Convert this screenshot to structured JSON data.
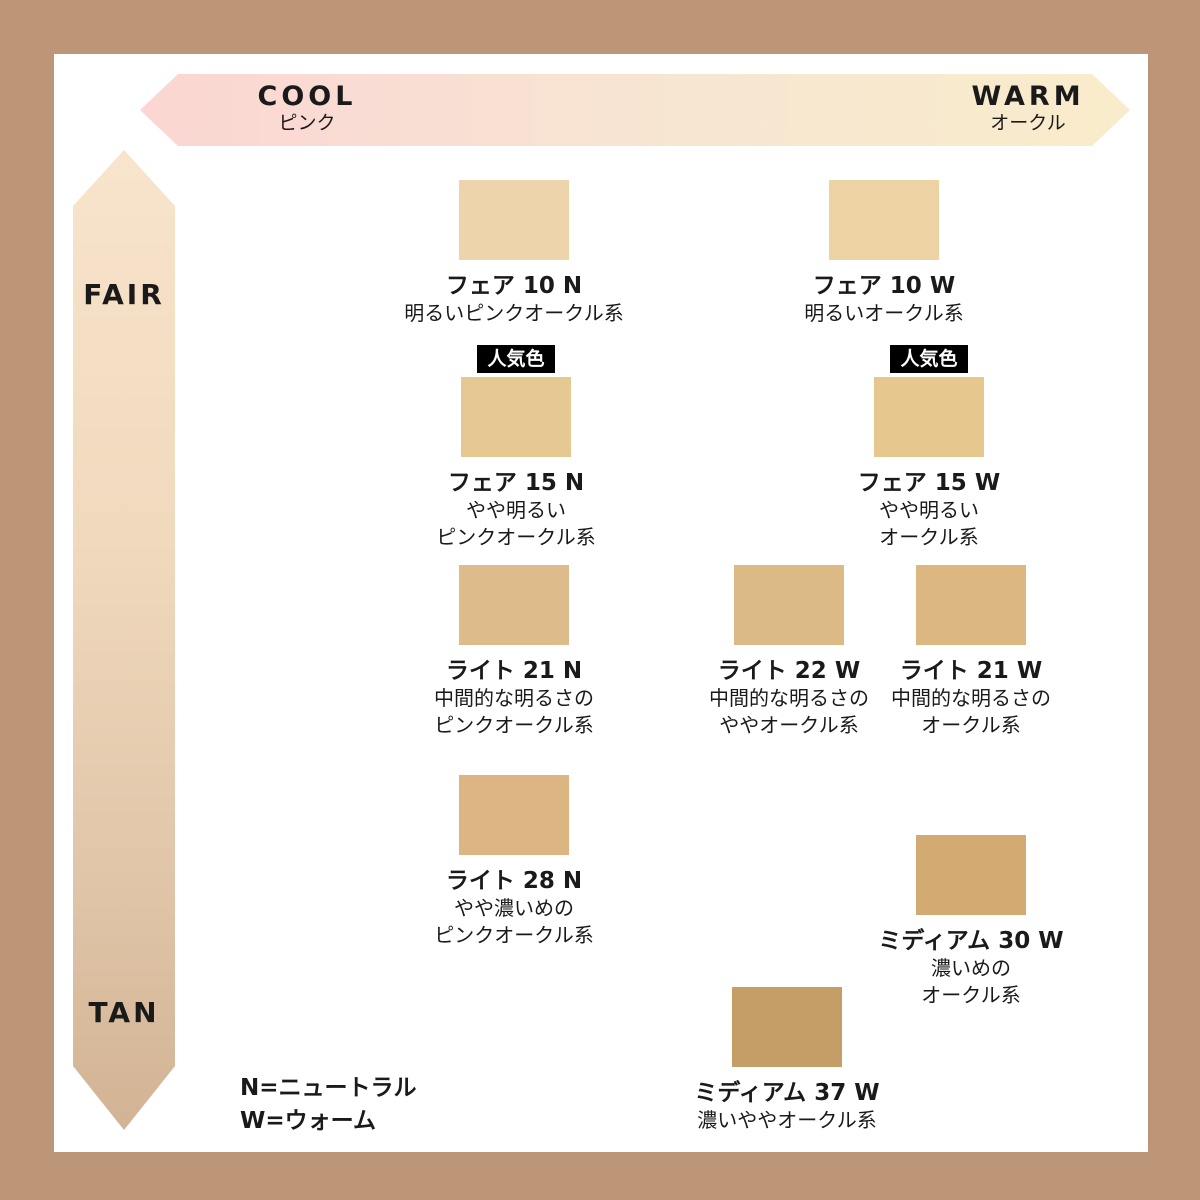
{
  "page": {
    "frame_color": "#bc9677",
    "canvas_color": "#ffffff",
    "text_color": "#1a1a1a"
  },
  "axes": {
    "cool_label": "COOL",
    "cool_sub": "ピンク",
    "warm_label": "WARM",
    "warm_sub": "オークル",
    "fair_label": "FAIR",
    "tan_label": "TAN",
    "horizontal_gradient": [
      "#fbd6d2",
      "#f9ecca"
    ],
    "vertical_gradient": [
      "#f8e4cc",
      "#d2b394"
    ]
  },
  "popular_badge_label": "人気色",
  "legend": {
    "line1": "N=ニュートラル",
    "line2": "W=ウォーム"
  },
  "shades": [
    {
      "name": "フェア 10 N",
      "desc1": "明るいピンクオークル系",
      "desc2": "",
      "color": "#edd4aa",
      "popular": false
    },
    {
      "name": "フェア 10 W",
      "desc1": "明るいオークル系",
      "desc2": "",
      "color": "#edd2a3",
      "popular": false
    },
    {
      "name": "フェア 15 N",
      "desc1": "やや明るい",
      "desc2": "ピンクオークル系",
      "color": "#e6c893",
      "popular": true
    },
    {
      "name": "フェア 15 W",
      "desc1": "やや明るい",
      "desc2": "オークル系",
      "color": "#e6c78e",
      "popular": true
    },
    {
      "name": "ライト 21 N",
      "desc1": "中間的な明るさの",
      "desc2": "ピンクオークル系",
      "color": "#debb8a",
      "popular": false
    },
    {
      "name": "ライト 22 W",
      "desc1": "中間的な明るさの",
      "desc2": "ややオークル系",
      "color": "#dcba85",
      "popular": false
    },
    {
      "name": "ライト 21 W",
      "desc1": "中間的な明るさの",
      "desc2": "オークル系",
      "color": "#dcb781",
      "popular": false
    },
    {
      "name": "ライト 28 N",
      "desc1": "やや濃いめの",
      "desc2": "ピンクオークル系",
      "color": "#ddb582",
      "popular": false
    },
    {
      "name": "ミディアム 30 W",
      "desc1": "濃いめの",
      "desc2": "オークル系",
      "color": "#d3ab72",
      "popular": false
    },
    {
      "name": "ミディアム 37 W",
      "desc1": "濃いややオークル系",
      "desc2": "",
      "color": "#c49d67",
      "popular": false
    }
  ]
}
